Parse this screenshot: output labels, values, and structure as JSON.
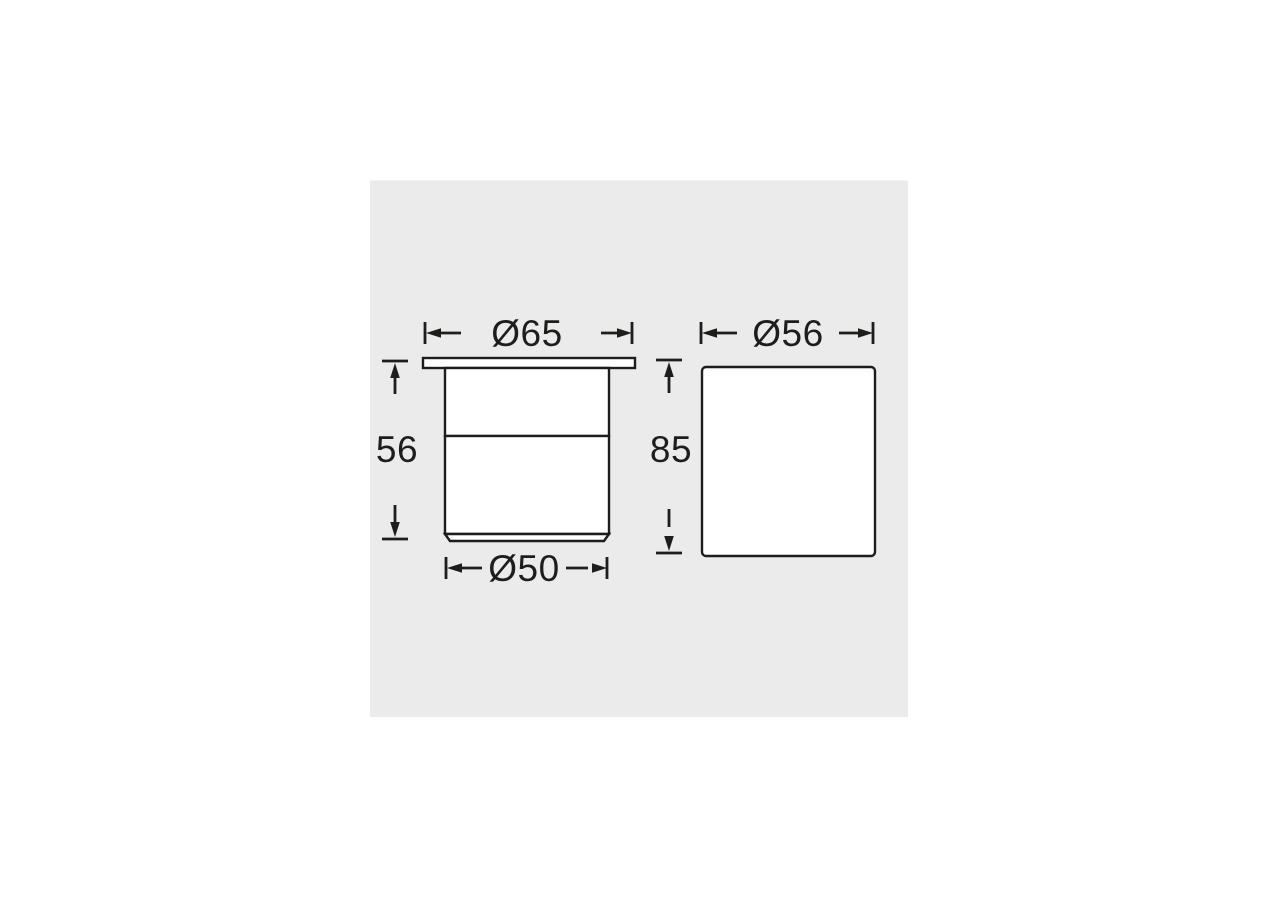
{
  "page": {
    "background": "#ffffff",
    "panel_background": "#ebebeb",
    "line_color": "#1d1d1b"
  },
  "diagram": {
    "description": "Two-view technical dimension drawing of a recessed ground light fixture",
    "front_view": {
      "flange_diameter_label": "Ø65",
      "height_label": "56",
      "body_diameter_label": "Ø50"
    },
    "side_view": {
      "diameter_label": "Ø56",
      "height_label": "85"
    }
  }
}
